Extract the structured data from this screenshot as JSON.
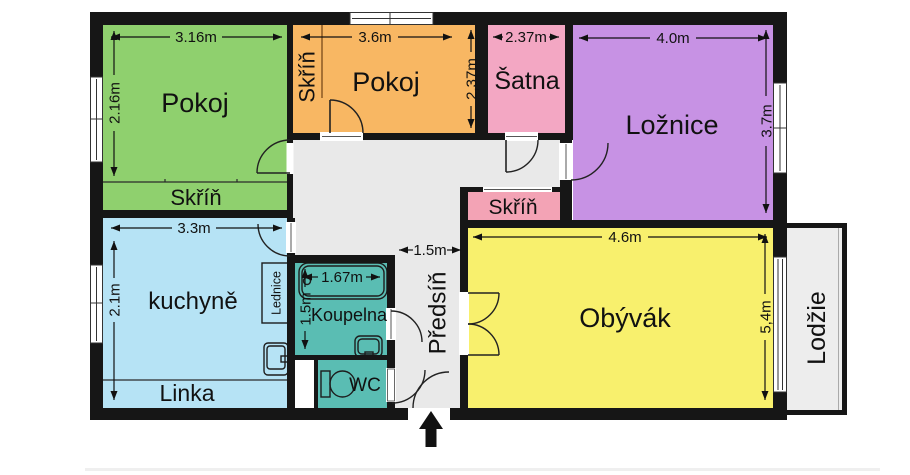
{
  "colors": {
    "wall": "#161616",
    "label_text": "#111111",
    "closet_label_text": "#6b3413",
    "hall": "#e9e9e9"
  },
  "rooms": {
    "pokoj_left": {
      "label": "Pokoj",
      "color": "#8fd06e",
      "width": "3.16m",
      "height": "2.16m",
      "closet": {
        "label": "Skříň"
      }
    },
    "pokoj_top": {
      "label": "Pokoj",
      "color": "#f8b763",
      "width": "3.6m",
      "height": "2,37m",
      "closet": {
        "label": "Skříň"
      }
    },
    "satna": {
      "label": "Šatna",
      "color": "#f3a7c3",
      "width": "2.37m"
    },
    "loznice": {
      "label": "Ložnice",
      "color": "#c792e4",
      "width": "4.0m",
      "height": "3.7m"
    },
    "hall_closet": {
      "label": "Skříň",
      "color": "#f3a3b5"
    },
    "kuchyne": {
      "label": "kuchyně",
      "color": "#b6e3f5",
      "width": "3.3m",
      "height": "2.1m",
      "fridge_label": "Lednice",
      "counter_label": "Linka"
    },
    "koupelna": {
      "label": "Koupelna",
      "color": "#5abdb3",
      "width": "1.67m",
      "height": "1.5m"
    },
    "wc": {
      "label": "WC",
      "color": "#5abdb3"
    },
    "predsin": {
      "label": "Předsíň",
      "color": "#e9e9e9",
      "width": "1.5m"
    },
    "obyvak": {
      "label": "Obývák",
      "color": "#f8f06d",
      "width": "4.6m",
      "height": "5,4m"
    },
    "lodzie": {
      "label": "Lodžie",
      "color": "#ededed"
    }
  }
}
